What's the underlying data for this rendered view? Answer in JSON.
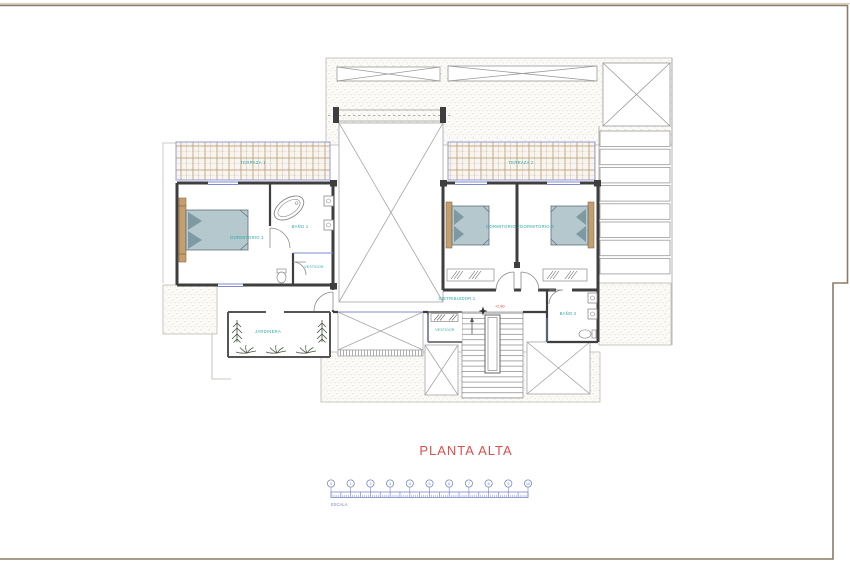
{
  "sheet": {
    "title": "PLANTA ALTA",
    "scale": {
      "label": "ESCALA",
      "numbers": [
        "0",
        "1",
        "2",
        "3",
        "4",
        "5",
        "6",
        "7",
        "8",
        "9",
        "10"
      ]
    }
  },
  "rooms": {
    "terraza1": "TERRAZA 1",
    "terraza2": "TERRAZA 2",
    "dormitorio1": "DORMITORIO 1",
    "bano1": "BAÑO 1",
    "vestidor1": "VESTIDOR",
    "dormitorio2": "DORMITORIO 2",
    "dormitorio3": "DORMITORIO 3",
    "distribuidor": "DISTRIBUIDOR 1",
    "vestidor2": "VESTIDOR",
    "bano2": "BAÑO 2",
    "jardinera": "JARDINERA"
  },
  "annotations": {
    "level": "+2.80"
  },
  "colors": {
    "title_red": "#d95050",
    "label_teal": "#2aa7a4",
    "scale_blue": "#7b86c8",
    "glazing_blue": "#8089d0",
    "wall_dark": "#3e3e3e",
    "wood_tan": "#c59e6d",
    "bed_fill": "#b4c8cd",
    "frame_brown": "#8b7b69"
  }
}
